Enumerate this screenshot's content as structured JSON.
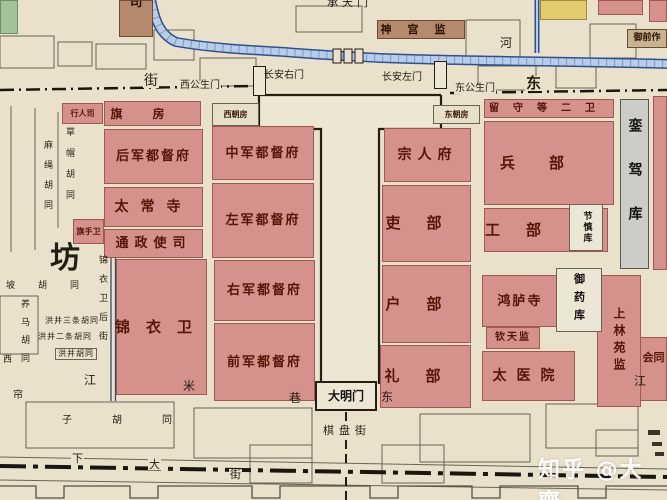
{
  "watermark": {
    "text": "知乎 @大齊"
  },
  "palette": {
    "paper": "#e9e1cc",
    "office_red": "#d5918c",
    "office_red_border": "#a3584e",
    "office_text": "#551507",
    "tan": "#b5896b",
    "yellow": "#e3ca6c",
    "green": "#a3c29b",
    "gray": "#cccdc7",
    "river_fill": "#b9cde8",
    "river_edge": "#2f4f8f",
    "wall": "#241d12",
    "outline": "#6b6455"
  },
  "blocks": [
    {
      "id": "xingrensi",
      "label": "行人司",
      "x": 62,
      "y": 103,
      "w": 41,
      "h": 21,
      "f": "#d5918c",
      "fs": 8
    },
    {
      "id": "qifang",
      "label": "旗房",
      "x": 104,
      "y": 101,
      "w": 97,
      "h": 25,
      "f": "#d5918c",
      "fs": 12,
      "sp": 30
    },
    {
      "id": "houjun-dudufu",
      "label": "后军都督府",
      "x": 104,
      "y": 129,
      "w": 99,
      "h": 55,
      "f": "#d5918c",
      "fs": 13,
      "sp": 2
    },
    {
      "id": "taichangsi",
      "label": "太常寺",
      "x": 104,
      "y": 187,
      "w": 99,
      "h": 40,
      "f": "#d5918c",
      "fs": 14,
      "sp": 12
    },
    {
      "id": "tongzhengshisi",
      "label": "通政使司",
      "x": 104,
      "y": 229,
      "w": 99,
      "h": 29,
      "f": "#d5918c",
      "fs": 13,
      "sp": 6
    },
    {
      "id": "qishouwei",
      "label": "旗手卫",
      "x": 73,
      "y": 219,
      "w": 31,
      "h": 25,
      "f": "#d5918c",
      "fs": 8
    },
    {
      "id": "jinyiwei",
      "label": "锦衣卫",
      "x": 116,
      "y": 259,
      "w": 91,
      "h": 136,
      "f": "#d5918c",
      "fs": 15,
      "sp": 16
    },
    {
      "id": "zhongjun-dudufu",
      "label": "中军都督府",
      "x": 212,
      "y": 126,
      "w": 102,
      "h": 54,
      "f": "#d5918c",
      "fs": 13,
      "sp": 2
    },
    {
      "id": "zuojun-dudufu",
      "label": "左军都督府",
      "x": 212,
      "y": 183,
      "w": 102,
      "h": 75,
      "f": "#d5918c",
      "fs": 13,
      "sp": 2
    },
    {
      "id": "youjun-dudufu",
      "label": "右军都督府",
      "x": 214,
      "y": 260,
      "w": 101,
      "h": 61,
      "f": "#d5918c",
      "fs": 13,
      "sp": 2
    },
    {
      "id": "qianjun-dudufu",
      "label": "前军都督府",
      "x": 214,
      "y": 323,
      "w": 101,
      "h": 78,
      "f": "#d5918c",
      "fs": 13,
      "sp": 2
    },
    {
      "id": "zongrenfu",
      "label": "宗人府",
      "x": 384,
      "y": 128,
      "w": 87,
      "h": 54,
      "f": "#d5918c",
      "fs": 14,
      "sp": 6
    },
    {
      "id": "libu-personnel",
      "label": "吏部",
      "x": 382,
      "y": 185,
      "w": 89,
      "h": 77,
      "f": "#d5918c",
      "fs": 15,
      "sp": 26
    },
    {
      "id": "hubu",
      "label": "户部",
      "x": 382,
      "y": 265,
      "w": 89,
      "h": 78,
      "f": "#d5918c",
      "fs": 15,
      "sp": 26
    },
    {
      "id": "libu-rites",
      "label": "礼部",
      "x": 380,
      "y": 345,
      "w": 91,
      "h": 63,
      "f": "#d5918c",
      "fs": 15,
      "sp": 26
    },
    {
      "id": "liushou-deng-erwei",
      "label": "留守等二卫",
      "x": 484,
      "y": 99,
      "w": 130,
      "h": 19,
      "f": "#d5918c",
      "fs": 10,
      "sp": 14
    },
    {
      "id": "bingbu",
      "label": "兵部",
      "x": 484,
      "y": 121,
      "w": 130,
      "h": 84,
      "f": "#d5918c",
      "fs": 15,
      "sp": 34
    },
    {
      "id": "gongbu",
      "label": "工部",
      "x": 484,
      "y": 208,
      "w": 124,
      "h": 44,
      "f": "#d5918c",
      "fs": 15,
      "sp": 26,
      "pr": 40
    },
    {
      "id": "honglusi",
      "label": "鸿胪寺",
      "x": 482,
      "y": 275,
      "w": 76,
      "h": 52,
      "f": "#d5918c",
      "fs": 13,
      "sp": 2
    },
    {
      "id": "qintianjian",
      "label": "钦天监",
      "x": 486,
      "y": 327,
      "w": 54,
      "h": 22,
      "f": "#d5918c",
      "fs": 10,
      "sp": 2
    },
    {
      "id": "taiyiyuan",
      "label": "太医院",
      "x": 482,
      "y": 351,
      "w": 93,
      "h": 50,
      "f": "#d5918c",
      "fs": 14,
      "sp": 10
    },
    {
      "id": "shanglin-yuanjian",
      "label": "上林苑监",
      "x": 597,
      "y": 275,
      "w": 44,
      "h": 132,
      "f": "#d5918c",
      "fs": 12,
      "sp": 5,
      "vertical": true
    },
    {
      "id": "huitongguan",
      "label": "会同",
      "x": 640,
      "y": 337,
      "w": 27,
      "h": 64,
      "f": "#d5918c",
      "fs": 11,
      "top": 14
    },
    {
      "id": "red-block-top-a",
      "x": 598,
      "y": 0,
      "w": 45,
      "h": 15,
      "f": "#d5918c"
    },
    {
      "id": "red-block-top-b",
      "x": 649,
      "y": 0,
      "w": 18,
      "h": 22,
      "f": "#d5918c"
    },
    {
      "id": "red-strip-east",
      "x": 653,
      "y": 96,
      "w": 14,
      "h": 174,
      "f": "#d5918c"
    },
    {
      "id": "si-office",
      "label": "司",
      "x": 119,
      "y": 0,
      "w": 34,
      "h": 37,
      "f": "#b5896b",
      "b": "#70492f",
      "fs": 13,
      "tc": "#2c1204",
      "top": -5,
      "clip": true
    },
    {
      "id": "shengongjian",
      "label": "神宫监",
      "x": 377,
      "y": 20,
      "w": 88,
      "h": 19,
      "f": "#b5896b",
      "b": "#70492f",
      "fs": 11,
      "sp": 16,
      "tc": "#2c1204"
    },
    {
      "id": "yuqianzuo",
      "label": "御前作",
      "x": 627,
      "y": 29,
      "w": 40,
      "h": 19,
      "f": "#c6b392",
      "b": "#70492f",
      "fs": 9,
      "tc": "#2c1204"
    },
    {
      "id": "yellow-block",
      "x": 540,
      "y": 0,
      "w": 47,
      "h": 20,
      "f": "#e3ca6c",
      "b": "#a08b3a"
    },
    {
      "id": "green-block",
      "x": 0,
      "y": 0,
      "w": 18,
      "h": 34,
      "f": "#a3c29b",
      "b": "#6d8f66"
    },
    {
      "id": "luanjiaku",
      "label": "銮驾库",
      "x": 620,
      "y": 99,
      "w": 29,
      "h": 170,
      "f": "#cccdc7",
      "b": "#595751",
      "fs": 14,
      "sp": 30,
      "vertical": true,
      "tc": "#14120e"
    },
    {
      "id": "jieshenku",
      "label": "节慎库",
      "x": 569,
      "y": 204,
      "w": 34,
      "h": 47,
      "f": "#ece6d4",
      "b": "#6b6253",
      "fs": 9,
      "sp": 2,
      "vertical": true,
      "tc": "#14120e"
    },
    {
      "id": "yuyaoku",
      "label": "御药库",
      "x": 556,
      "y": 268,
      "w": 46,
      "h": 64,
      "f": "#ece6d4",
      "b": "#6b6253",
      "fs": 11,
      "sp": 7,
      "vertical": true,
      "tc": "#14120e"
    },
    {
      "id": "xichaofang",
      "label": "西朝房",
      "x": 212,
      "y": 103,
      "w": 47,
      "h": 23,
      "f": "#e6dfc9",
      "b": "#6b6253",
      "fs": 8,
      "tc": "#3c1408"
    },
    {
      "id": "dongchaofang",
      "label": "东朝房",
      "x": 433,
      "y": 105,
      "w": 47,
      "h": 19,
      "f": "#e6dfc9",
      "b": "#6b6253",
      "fs": 8,
      "tc": "#3c1408"
    },
    {
      "id": "damingmen",
      "label": "大明门",
      "x": 315,
      "y": 381,
      "w": 62,
      "h": 30,
      "f": "#ece6d4",
      "b": "#241d12",
      "fs": 12,
      "tc": "#14120e",
      "thick": true
    },
    {
      "id": "gate-changan-right",
      "x": 253,
      "y": 66,
      "w": 13,
      "h": 30,
      "f": "#ece6d4",
      "b": "#241d12"
    },
    {
      "id": "gate-changan-left",
      "x": 434,
      "y": 61,
      "w": 13,
      "h": 28,
      "f": "#ece6d4",
      "b": "#241d12"
    }
  ],
  "labels": [
    {
      "id": "chengtianmen",
      "text": "承天门",
      "x": 327,
      "y": -3,
      "fs": 11,
      "sp": 4
    },
    {
      "id": "river-he",
      "text": "河",
      "x": 500,
      "y": 37,
      "fs": 12
    },
    {
      "id": "street-jie-west",
      "text": "街",
      "x": 143,
      "y": 74,
      "fs": 14,
      "bg": true
    },
    {
      "id": "xigongshengmen",
      "text": "西公生门",
      "x": 179,
      "y": 81,
      "fs": 10,
      "bg": true
    },
    {
      "id": "changanyoumen",
      "text": "长安右门",
      "x": 264,
      "y": 71,
      "fs": 10
    },
    {
      "id": "changanzuomen",
      "text": "长安左门",
      "x": 382,
      "y": 73,
      "fs": 10
    },
    {
      "id": "donggongshengmen",
      "text": "东公生门",
      "x": 454,
      "y": 84,
      "fs": 10,
      "bg": true
    },
    {
      "id": "dong-east-big",
      "text": "东",
      "x": 525,
      "y": 76,
      "fs": 15,
      "bg": true,
      "bold": true
    },
    {
      "id": "fang-ward",
      "text": "坊",
      "x": 50,
      "y": 244,
      "fs": 30,
      "bold": true
    },
    {
      "id": "masheng-hutong",
      "text": "麻绳胡同",
      "x": 42,
      "y": 140,
      "fs": 9,
      "sp": 11,
      "vertical": true
    },
    {
      "id": "caomao-hutong",
      "text": "草帽胡同",
      "x": 64,
      "y": 127,
      "fs": 9,
      "sp": 12,
      "vertical": true
    },
    {
      "id": "po-hutong",
      "text": "坡胡同",
      "x": 6,
      "y": 282,
      "fs": 9,
      "sp": 23
    },
    {
      "id": "yangma-hutong",
      "text": "养马胡同",
      "x": 19,
      "y": 299,
      "fs": 9,
      "sp": 9,
      "vertical": true
    },
    {
      "id": "hongjing-santiao-hutong",
      "text": "洪井三条胡同",
      "x": 45,
      "y": 317,
      "fs": 8,
      "sp": 1
    },
    {
      "id": "hongjing-ertiao-hutong",
      "text": "洪井二条胡同",
      "x": 38,
      "y": 333,
      "fs": 8,
      "sp": 1
    },
    {
      "id": "hongjing-hutong",
      "text": "洪井胡同",
      "x": 55,
      "y": 348,
      "fs": 8,
      "sp": 1,
      "box": true
    },
    {
      "id": "xi-west",
      "text": "西",
      "x": 3,
      "y": 356,
      "fs": 9
    },
    {
      "id": "jinyiwei-back-street",
      "text": "锦衣卫后街",
      "x": 97,
      "y": 255,
      "fs": 9,
      "sp": 10,
      "vertical": true
    },
    {
      "id": "jiang-west",
      "text": "江",
      "x": 84,
      "y": 374,
      "fs": 12
    },
    {
      "id": "mi-street",
      "text": "米",
      "x": 183,
      "y": 380,
      "fs": 12
    },
    {
      "id": "xiang-street",
      "text": "巷",
      "x": 289,
      "y": 392,
      "fs": 12
    },
    {
      "id": "dong-street",
      "text": "东",
      "x": 381,
      "y": 391,
      "fs": 12
    },
    {
      "id": "jiang-east",
      "text": "江",
      "x": 634,
      "y": 375,
      "fs": 12
    },
    {
      "id": "qipanjie",
      "text": "棋盘街",
      "x": 322,
      "y": 425,
      "fs": 11,
      "sp": 5,
      "bg": true
    },
    {
      "id": "lianzi-hutong-first",
      "text": "帘",
      "x": 13,
      "y": 391,
      "fs": 10
    },
    {
      "id": "zi-hutong",
      "text": "子胡同",
      "x": 62,
      "y": 416,
      "fs": 10,
      "sp": 40
    },
    {
      "id": "xia-street",
      "text": "下",
      "x": 71,
      "y": 453,
      "fs": 11,
      "bg": true
    },
    {
      "id": "da-street",
      "text": "大",
      "x": 148,
      "y": 459,
      "fs": 11,
      "bg": true
    },
    {
      "id": "jie-bottom",
      "text": "街",
      "x": 229,
      "y": 469,
      "fs": 11,
      "bg": true
    }
  ]
}
